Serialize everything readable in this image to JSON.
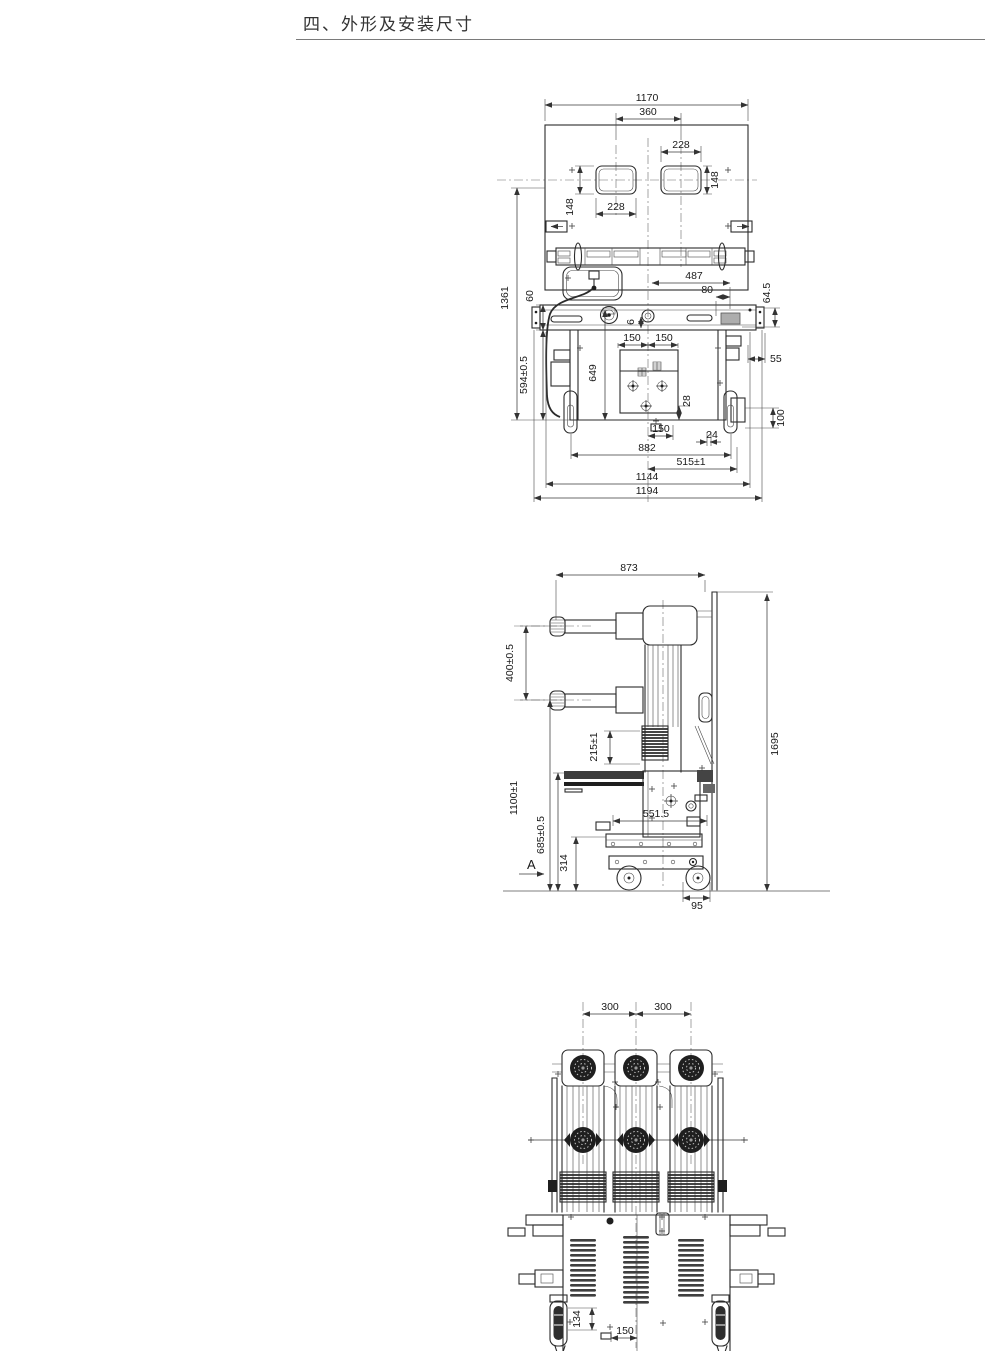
{
  "title": "四、外形及安装尺寸",
  "colors": {
    "line": "#2b2b2b",
    "dimension": "#3a3a3a"
  },
  "front_view": {
    "plan_overall_width": "1170",
    "plan_pocket_spacing": "360",
    "plan_pocket_width_right": "228",
    "plan_pocket_height_right": "148",
    "plan_pocket_height_left": "148",
    "plan_pocket_width_left": "228",
    "beam_hole_offset": "487",
    "beam_hole_pitch": "80",
    "beam_height_right": "64.5",
    "overall_depth": "1361",
    "beam_height_left": "60",
    "beam_step": "6",
    "panel_half_left": "150",
    "panel_half_right": "150",
    "side_offset": "55",
    "body_height": "594±0.5",
    "inner_height": "649",
    "bottom_step": "28",
    "wheel_height": "100",
    "ground_terminal_offset": "150",
    "bottom_gap": "24",
    "wheel_span": "882",
    "half_span": "515±1",
    "mount_width": "1144",
    "beam_width": "1194"
  },
  "side_view": {
    "overall_depth": "873",
    "arm_pitch": "400±0.5",
    "bellows_height": "215±1",
    "overall_height": "1695",
    "lower_arm_height": "1100±1",
    "carriage_depth": "551.5",
    "rail_height": "685±0.5",
    "truck_height": "314",
    "rear_wheel_offset": "95",
    "section_label": "A"
  },
  "rear_view": {
    "phase_spacing_left": "300",
    "phase_spacing_right": "300",
    "wheel_dim": "134",
    "bottom_offset": "150"
  }
}
